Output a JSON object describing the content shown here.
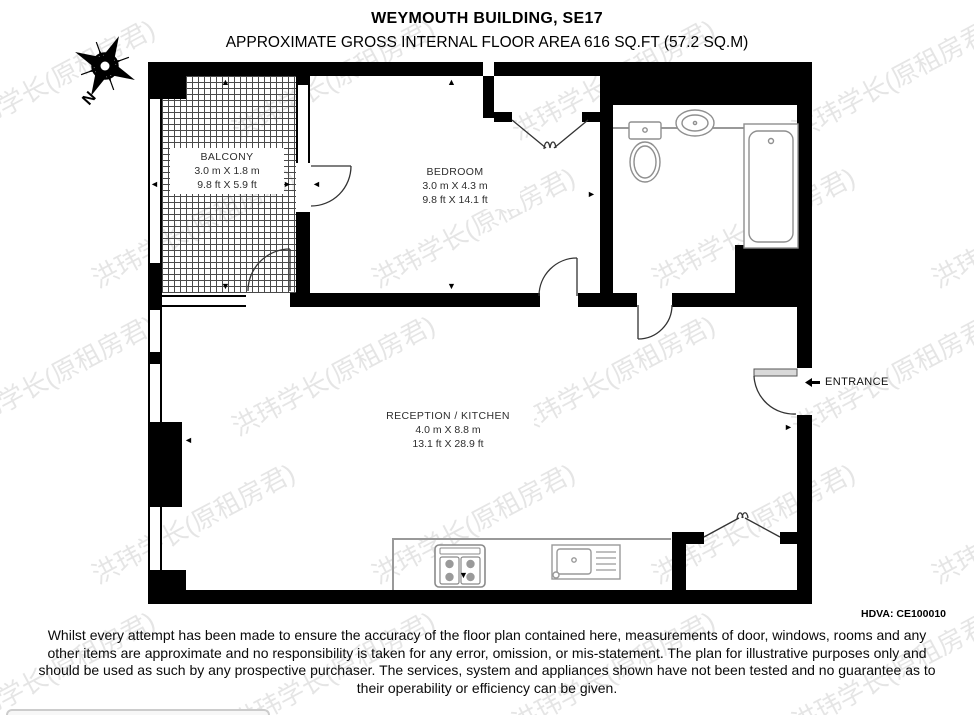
{
  "header": {
    "title": "WEYMOUTH BUILDING, SE17",
    "subtitle": "APPROXIMATE GROSS INTERNAL FLOOR AREA 616 SQ.FT (57.2 SQ.M)"
  },
  "compass": {
    "label": "N"
  },
  "rooms": [
    {
      "id": "balcony",
      "name": "BALCONY",
      "size_metric": "3.0 m X 1.8 m",
      "size_imperial": "9.8 ft X 5.9 ft"
    },
    {
      "id": "bedroom",
      "name": "BEDROOM",
      "size_metric": "3.0 m X 4.3 m",
      "size_imperial": "9.8 ft X 14.1 ft"
    },
    {
      "id": "reception",
      "name": "RECEPTION / KITCHEN",
      "size_metric": "4.0 m X 8.8 m",
      "size_imperial": "13.1 ft X 28.9 ft"
    }
  ],
  "entrance": {
    "label": "ENTRANCE"
  },
  "reference": "HDVA: CE100010",
  "disclaimer": "Whilst every attempt has been made to ensure the accuracy of the floor plan contained here, measurements of door, windows, rooms and any other items are approximate and no responsibility is taken for any error, omission, or mis-statement. The plan for illustrative purposes only and should be used as such by any prospective purchaser. The services, system and appliances shown have not been tested and no guarantee as to their operability or efficiency can be given.",
  "watermark": {
    "text": "洪玮学长(原租房君)"
  },
  "icons": {
    "arrow_left": "◄",
    "arrow_right": "►",
    "arrow_up": "▲",
    "arrow_down": "▼"
  },
  "colors": {
    "wall": "#000000",
    "fixture_line": "#8f8f8f",
    "counter_line": "#999999"
  }
}
